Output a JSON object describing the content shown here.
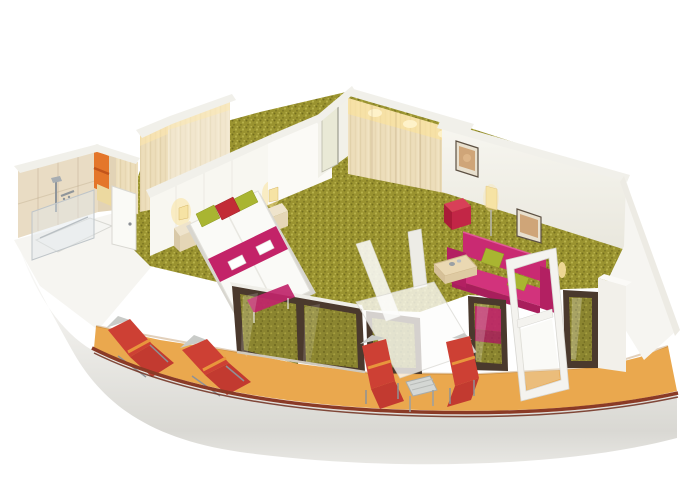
{
  "scene": {
    "title": "Cruise ship suite 3D floor plan",
    "description": "Isometric cutaway rendering of a wedge-shaped cruise cabin: bathroom with shower and orange towels, wardrobe corridor, bedroom with twin beds, magenta bed runner and green and red pillows, living area with magenta sofa, green cushions, coffee table, red cube ottoman and framed pictures, plus a curved balcony with red deck loungers, side tables, an open glass door and a dark railing cap above the white hull.",
    "rooms": [
      {
        "name": "bathroom",
        "features": [
          "shower",
          "glass screen",
          "orange towels",
          "door"
        ]
      },
      {
        "name": "hallway",
        "features": [
          "entrance door",
          "wood wardrobe"
        ]
      },
      {
        "name": "bedroom",
        "features": [
          "twin beds",
          "magenta runner with towels",
          "green pillows",
          "red pillow",
          "nightstand lamps",
          "magenta bench"
        ]
      },
      {
        "name": "living-area",
        "features": [
          "magenta sofa",
          "green cushions",
          "coffee table",
          "red cube ottoman",
          "floor lamp",
          "framed pictures"
        ]
      },
      {
        "name": "balcony",
        "features": [
          "four red loungers",
          "side table",
          "open glass door",
          "railing cap"
        ]
      }
    ]
  },
  "palette": {
    "background": "#ffffff",
    "wall_white": "#f6f5f1",
    "wall_bright": "#fbfaf6",
    "wall_cream": "#f2f1e9",
    "wall_cap": "#f1f0ea",
    "tile_beige": "#e9dcc4",
    "tile_side": "#e2d3b6",
    "wood_base": "#ecddba",
    "wood_stripe": "#d9c69c",
    "carpet_base": "#9a9330",
    "carpet_dot_dark": "#746e1e",
    "carpet_dot_light": "#b7b049",
    "glass_base": "#8b8530",
    "glass_dot_dark": "#6f6a20",
    "glass_dot_light": "#a59e3f",
    "balcony_floor": "#eaa84e",
    "rail_cap": "#8a3a26",
    "rail_cap_dark": "#6e2d1c",
    "window_frame": "#4a392d",
    "sofa_magenta": "#c92a72",
    "sofa_side": "#b32062",
    "sofa_seat": "#d2337c",
    "sofa_front": "#a81e5c",
    "bed_runner": "#c32368",
    "bench_magenta": "#c0256a",
    "armchair_magenta": "#c0256a",
    "pillow_green": "#a9b531",
    "pillow_red": "#c22b36",
    "ottoman_top": "#d84058",
    "ottoman_left": "#a91c38",
    "ottoman_right": "#c22646",
    "lounger_red": "#cd4034",
    "lounger_seat": "#c23a30",
    "lounger_band": "#e8953c",
    "chair_frame_gray": "#8e9296",
    "towel_orange": "#e4762a",
    "towel_yellow": "#ecd9a0",
    "door_cream": "#e9e9d6",
    "lamp_warm": "#f6e3a4",
    "chrome": "#8f959a"
  }
}
